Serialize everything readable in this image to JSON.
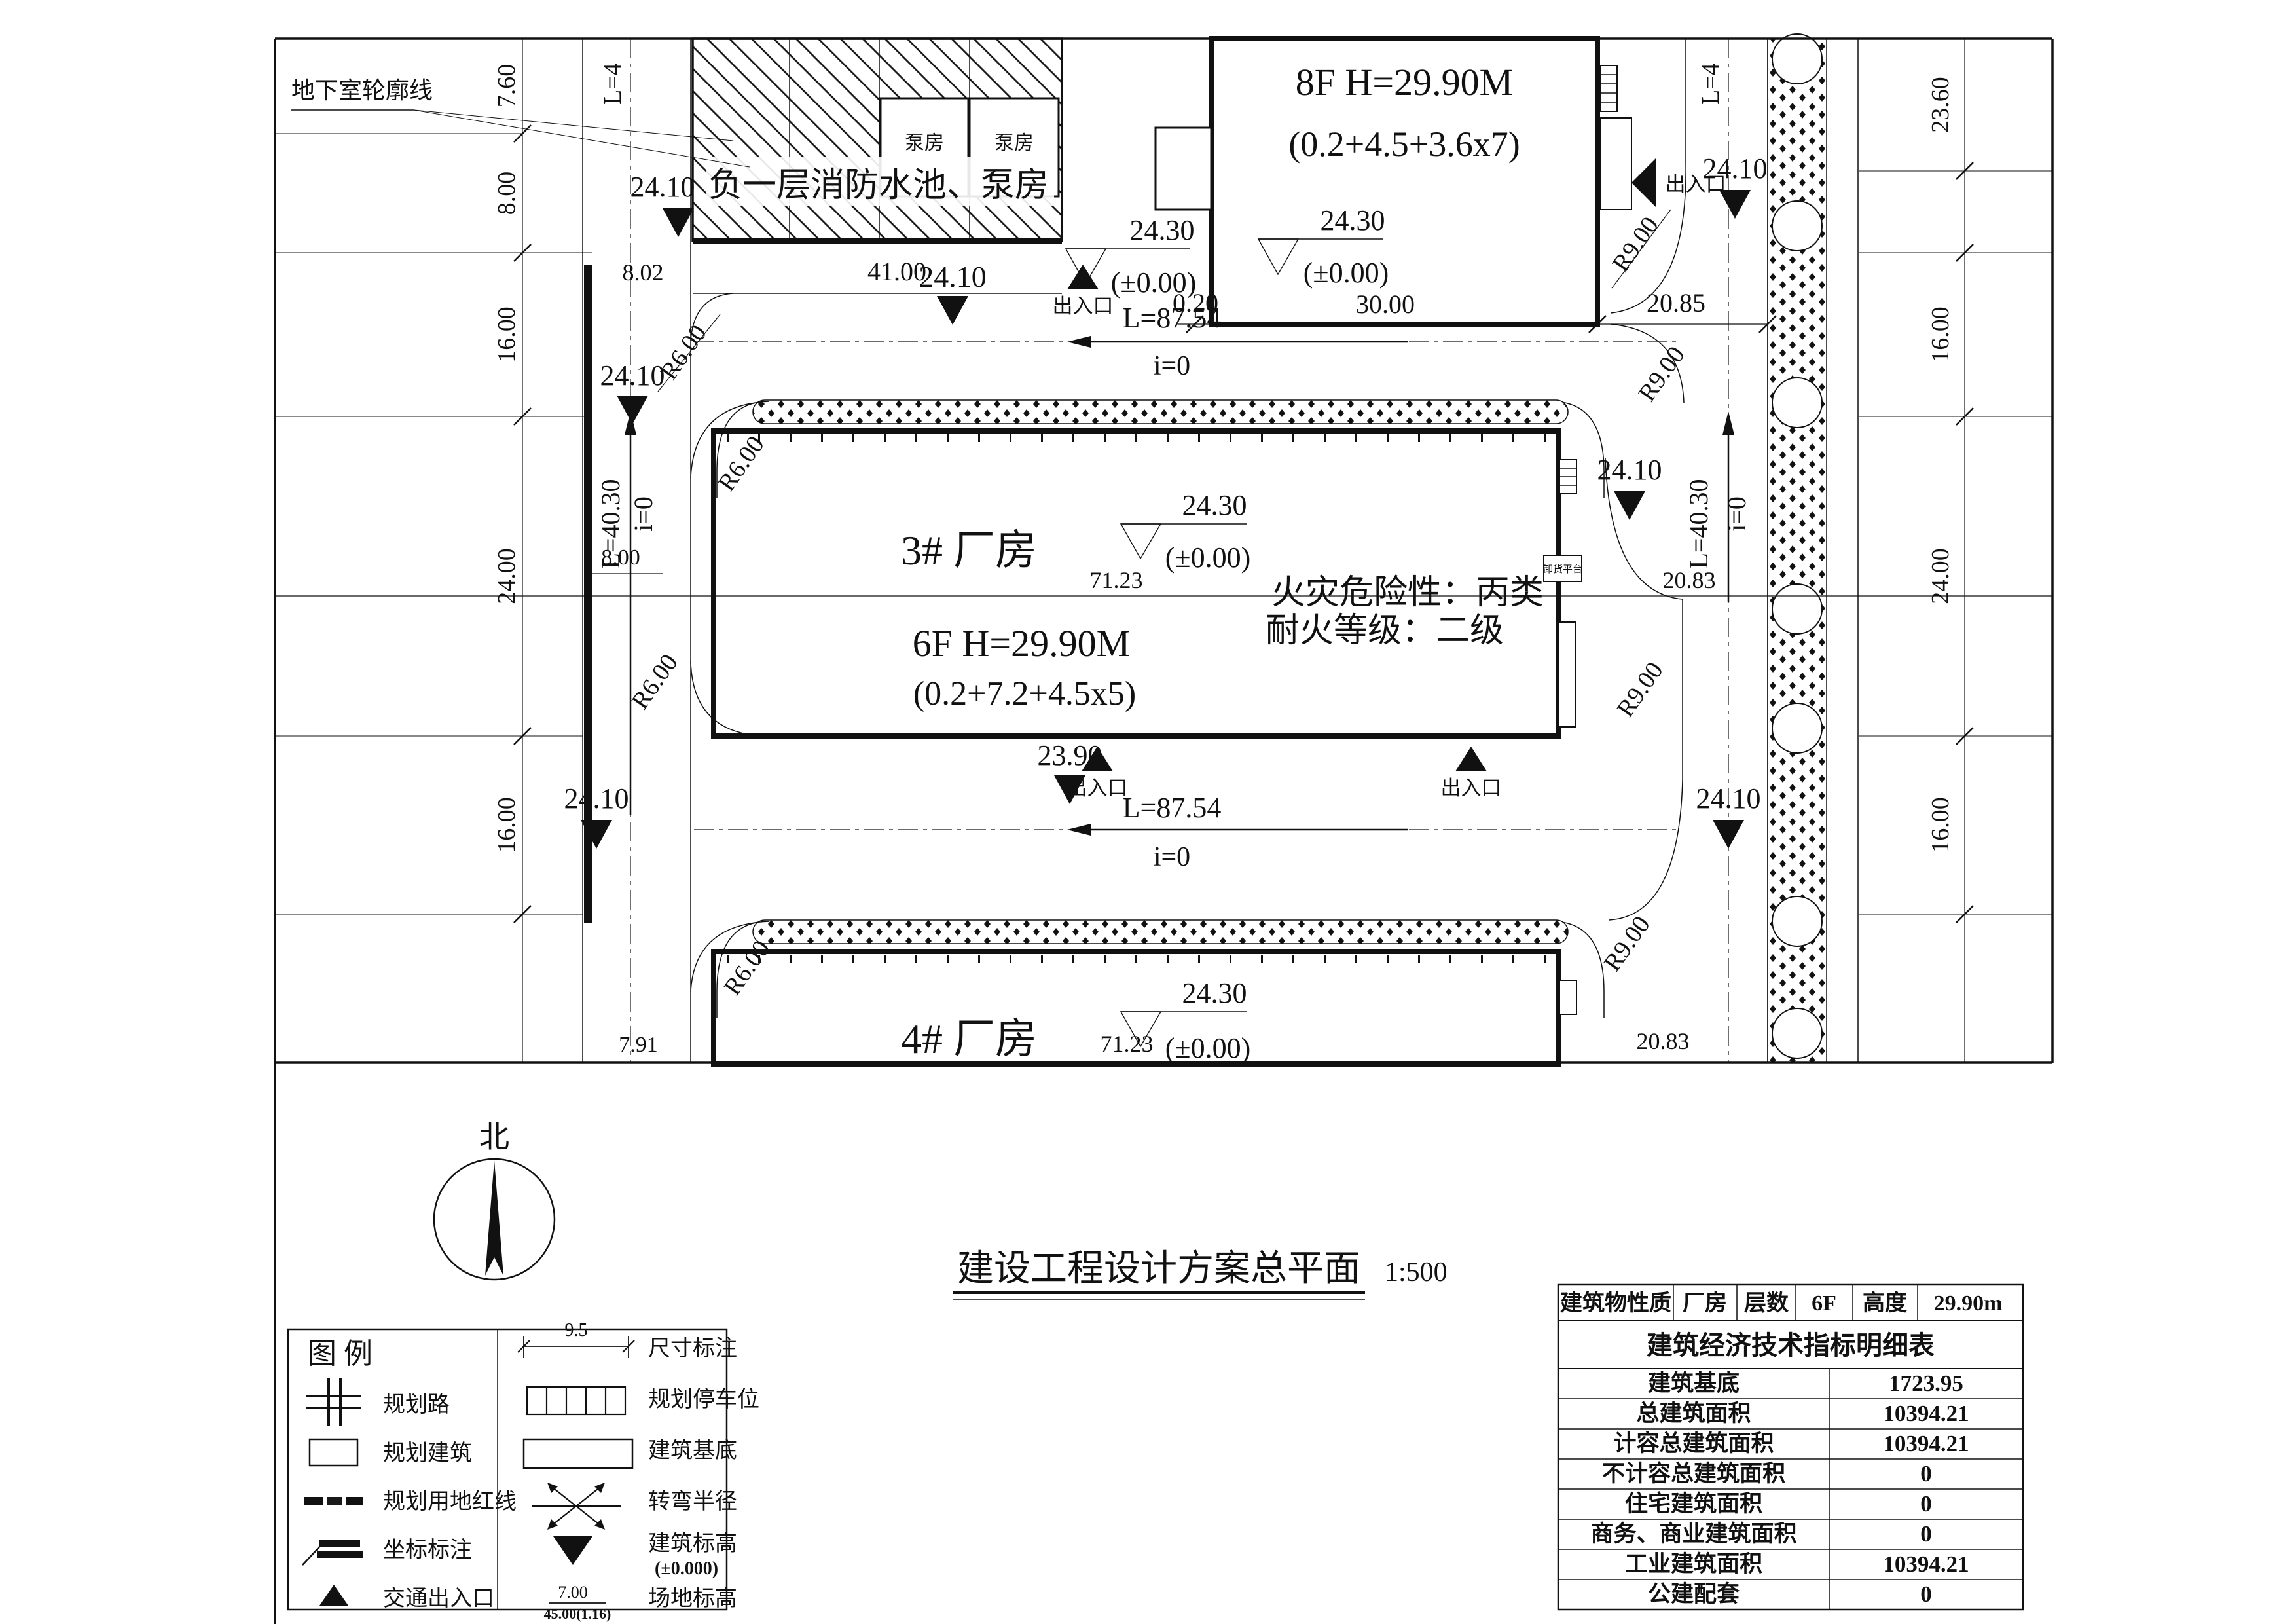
{
  "title_block": {
    "title": "建设工程设计方案总平面",
    "scale": "1:500",
    "north": "北"
  },
  "buildings": {
    "b8f": {
      "line1": "8F  H=29.90M",
      "line2": "(0.2+4.5+3.6x7)"
    },
    "b3": {
      "name": "3#  厂房",
      "line1": "6F  H=29.90M",
      "line2": "(0.2+7.2+4.5x5)",
      "fire_hazard": "火灾危险性：丙类",
      "fire_rating": "耐火等级：二级"
    },
    "b4": {
      "name": "4#  厂房"
    },
    "basement": {
      "label": "负一层消防水池、泵房",
      "pump_room": "泵房",
      "outline_label": "地下室轮廓线",
      "platform": "卸货平台"
    }
  },
  "markers": {
    "e2430": "24.30",
    "pm0": "(±0.00)",
    "e2410": "24.10",
    "e2390": "23.90",
    "entrance": "出入口"
  },
  "dims": {
    "d760": "7.60",
    "d800": "8.00",
    "d1600": "16.00",
    "d2400": "24.00",
    "d2360": "23.60",
    "d802": "8.02",
    "d4100": "41.00",
    "d020": "0.20",
    "d3000": "30.00",
    "d2085": "20.85",
    "d2083": "20.83",
    "d7123": "71.23",
    "d791": "7.91"
  },
  "roads": {
    "l8754": "L=87.54",
    "l4030": "L=40.30",
    "l4cut": "L=4",
    "i0": "i=0",
    "r6": "R6.00",
    "r9": "R9.00"
  },
  "legend": {
    "title": "图  例",
    "left": [
      {
        "label": "规划路"
      },
      {
        "label": "规划建筑"
      },
      {
        "label": "规划用地红线"
      },
      {
        "label": "坐标标注"
      },
      {
        "label": "交通出入口"
      }
    ],
    "right": [
      {
        "label": "尺寸标注",
        "sample": "9.5"
      },
      {
        "label": "规划停车位"
      },
      {
        "label": "建筑基底"
      },
      {
        "label": "转弯半径"
      },
      {
        "label": "建筑标高",
        "note": "(±0.000)"
      },
      {
        "label": "场地标高",
        "sample_a": "7.00",
        "sample_b": "45.00(1.16)"
      }
    ]
  },
  "table": {
    "header": [
      "建筑物性质",
      "厂房",
      "层数",
      "6F",
      "高度",
      "29.90m"
    ],
    "title": "建筑经济技术指标明细表",
    "rows": [
      [
        "建筑基底",
        "1723.95"
      ],
      [
        "总建筑面积",
        "10394.21"
      ],
      [
        "计容总建筑面积",
        "10394.21"
      ],
      [
        "不计容总建筑面积",
        "0"
      ],
      [
        "住宅建筑面积",
        "0"
      ],
      [
        "商务、商业建筑面积",
        "0"
      ],
      [
        "工业建筑面积",
        "10394.21"
      ],
      [
        "公建配套",
        "0"
      ]
    ]
  }
}
